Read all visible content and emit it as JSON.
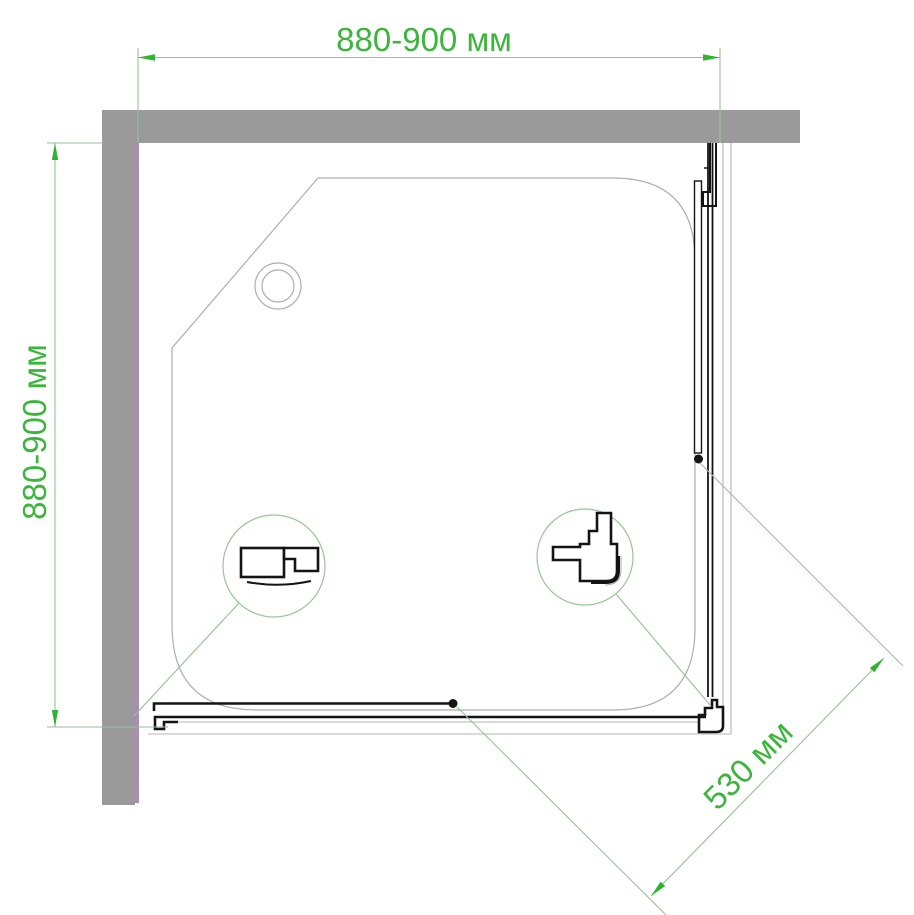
{
  "diagram": {
    "kind": "shower-enclosure-corner-top-view",
    "dimension_labels": {
      "top_width": "880-900 мм",
      "left_depth": "880-900 мм",
      "door_diagonal": "530 мм"
    },
    "colors": {
      "green_text": "#3cb53c",
      "green_arrow": "#2fb42f",
      "green_line": "#95c295",
      "wall_gray": "#9a9a9a",
      "wall_accent_purple": "#a88fb0",
      "drawing_black": "#141414",
      "outline_gray": "#aeaeae"
    }
  }
}
